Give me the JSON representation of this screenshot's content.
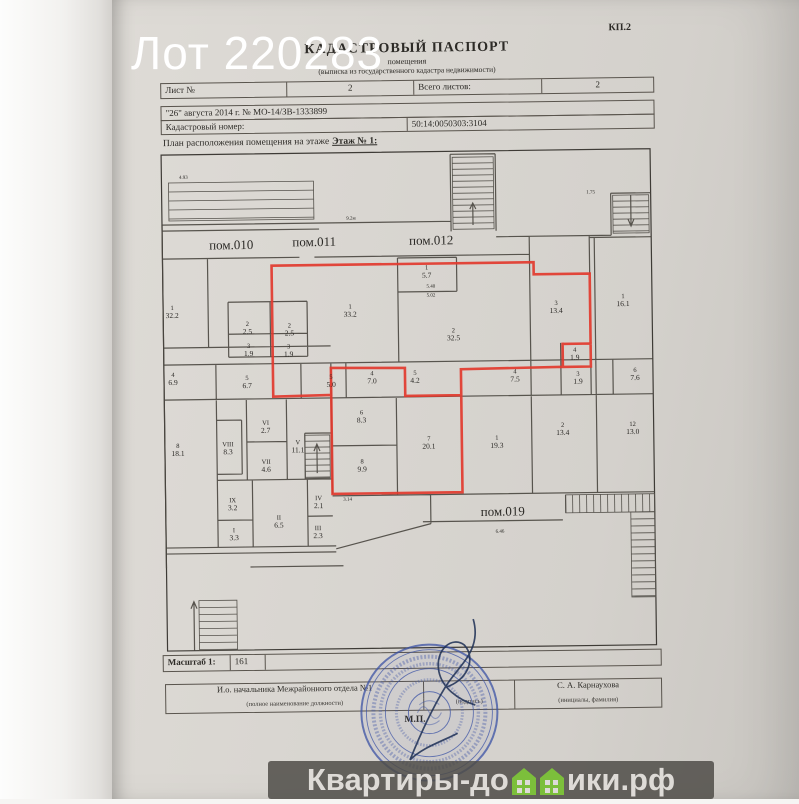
{
  "photo": {
    "lot_label": "Лот 220283"
  },
  "watermark": {
    "prefix": "Квартиры-до",
    "suffix": "ики.рф",
    "bar_color": "rgba(79,76,72,0.85)",
    "text_color": "#dedbd7",
    "house_color": "#7cbf3b"
  },
  "header": {
    "form_code": "КП.2",
    "title": "КАДАСТРОВЫЙ ПАСПОРТ",
    "subtitle": "помещения",
    "note": "(выписка из государственного кадастра недвижимости)"
  },
  "info_table": {
    "sheet_label": "Лист №",
    "sheet_value": "2",
    "total_label": "Всего листов:",
    "total_value": "2",
    "date_line": "\"26\" августа 2014 г. № МО-14/ЗВ-1333899",
    "cadastral_label": "Кадастровый номер:",
    "cadastral_value": "50:14:0050303:3104"
  },
  "plan": {
    "caption": "План расположения помещения на этаже",
    "floor": "Этаж № 1:",
    "highlight_color": "#e23a2e",
    "premises": [
      {
        "t": "пом.010",
        "x": 232,
        "y": 247
      },
      {
        "t": "пом.011",
        "x": 315,
        "y": 245
      },
      {
        "t": "пом.012",
        "x": 432,
        "y": 245
      },
      {
        "t": "пом.019",
        "x": 500,
        "y": 517
      }
    ],
    "rooms": [
      {
        "n": "1",
        "a": "32.2",
        "x": 172,
        "y": 309
      },
      {
        "n": "1",
        "a": "33.2",
        "x": 350,
        "y": 310
      },
      {
        "n": "2",
        "a": "32.5",
        "x": 453,
        "y": 335
      },
      {
        "n": "1",
        "a": "5.7",
        "x": 427,
        "y": 272
      },
      {
        "n": "3",
        "a": "13.4",
        "x": 556,
        "y": 309
      },
      {
        "n": "1",
        "a": "16.1",
        "x": 623,
        "y": 303
      },
      {
        "n": "2",
        "a": "2.5",
        "x": 247,
        "y": 326
      },
      {
        "n": "2",
        "a": "2.5",
        "x": 289,
        "y": 328
      },
      {
        "n": "3",
        "a": "1.9",
        "x": 248,
        "y": 348
      },
      {
        "n": "3",
        "a": "1.9",
        "x": 288,
        "y": 349
      },
      {
        "n": "4",
        "a": "6.9",
        "x": 172,
        "y": 376
      },
      {
        "n": "5",
        "a": "6.7",
        "x": 246,
        "y": 380
      },
      {
        "n": "5",
        "a": "5.0",
        "x": 330,
        "y": 380
      },
      {
        "n": "4",
        "a": "7.0",
        "x": 371,
        "y": 377
      },
      {
        "n": "5",
        "a": "4.2",
        "x": 414,
        "y": 377
      },
      {
        "n": "4",
        "a": "7.5",
        "x": 514,
        "y": 377
      },
      {
        "n": "3",
        "a": "1.9",
        "x": 577,
        "y": 380
      },
      {
        "n": "4",
        "a": "1.9",
        "x": 574,
        "y": 356
      },
      {
        "n": "6",
        "a": "7.6",
        "x": 634,
        "y": 377
      },
      {
        "n": "6",
        "a": "8.3",
        "x": 360,
        "y": 416
      },
      {
        "n": "8",
        "a": "9.9",
        "x": 360,
        "y": 465
      },
      {
        "n": "7",
        "a": "20.1",
        "x": 427,
        "y": 443
      },
      {
        "n": "1",
        "a": "19.3",
        "x": 495,
        "y": 443
      },
      {
        "n": "2",
        "a": "13.4",
        "x": 561,
        "y": 431
      },
      {
        "n": "12",
        "a": "13.0",
        "x": 631,
        "y": 431
      },
      {
        "n": "8",
        "a": "18.1",
        "x": 176,
        "y": 447
      },
      {
        "n": "VIII",
        "a": "8.3",
        "x": 226,
        "y": 446
      },
      {
        "n": "VI",
        "a": "2.7",
        "x": 264,
        "y": 425
      },
      {
        "n": "VII",
        "a": "4.6",
        "x": 264,
        "y": 464
      },
      {
        "n": "V",
        "a": "11.1",
        "x": 296,
        "y": 445
      },
      {
        "n": "IX",
        "a": "3.2",
        "x": 230,
        "y": 502
      },
      {
        "n": "I",
        "a": "3.3",
        "x": 231,
        "y": 532
      },
      {
        "n": "II",
        "a": "6.5",
        "x": 276,
        "y": 520
      },
      {
        "n": "IV",
        "a": "2.1",
        "x": 316,
        "y": 501
      },
      {
        "n": "III",
        "a": "2.3",
        "x": 315,
        "y": 531
      }
    ],
    "dims": [
      {
        "t": "4.93",
        "x": 185,
        "y": 176
      },
      {
        "t": "9.2м",
        "x": 352,
        "y": 219
      },
      {
        "t": "1.75",
        "x": 592,
        "y": 196
      },
      {
        "t": "5.40",
        "x": 431,
        "y": 288
      },
      {
        "t": "5.02",
        "x": 431,
        "y": 297
      },
      {
        "t": "3.14",
        "x": 345,
        "y": 500
      },
      {
        "t": "6.46",
        "x": 497,
        "y": 534
      }
    ]
  },
  "footer": {
    "scale_label": "Масштаб 1:",
    "scale_value": "161",
    "position": "И.о. начальника Межрайонного отдела №1",
    "position_hint": "(полное наименование должности)",
    "signature_hint": "(подпись)",
    "name": "С. А. Карнаухова",
    "name_hint": "(инициалы, фамилия)",
    "stamp_mark": "М.П."
  }
}
